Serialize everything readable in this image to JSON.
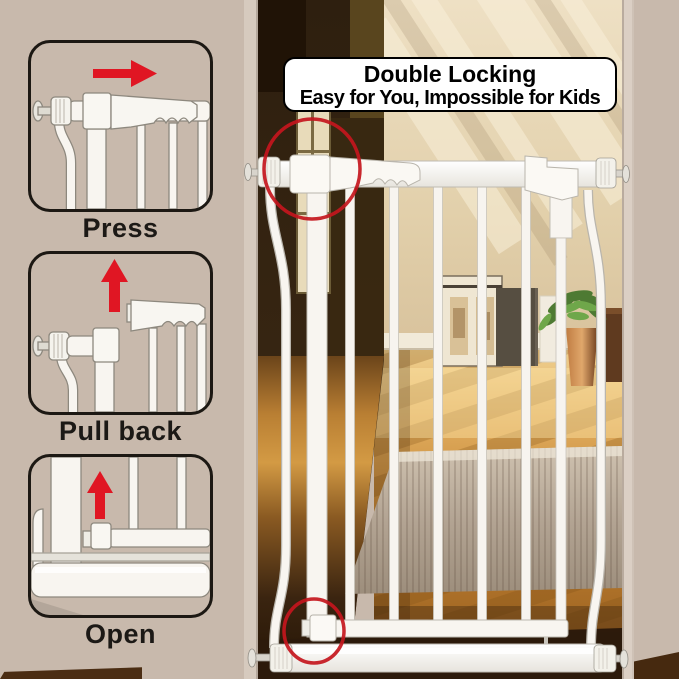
{
  "image_type": "product marketing image of a pressure-mounted baby safety gate installed in a doorway",
  "title_box": {
    "line1": "Double Locking",
    "line2": "Easy for You, Impossible for Kids"
  },
  "instruction_panels": [
    {
      "label": "Press",
      "arrow_direction": "right",
      "icon": "red-arrow-right-icon"
    },
    {
      "label": "Pull back",
      "arrow_direction": "up",
      "icon": "red-arrow-up-icon"
    },
    {
      "label": "Open",
      "arrow_direction": "up",
      "icon": "red-arrow-up-icon"
    }
  ],
  "photo": {
    "scene": "white metal safety gate in a doorway; dark hallway on left, sunlit beige wall, parquet wood floor, taupe rug, framed artwork, potted plant",
    "annotations": [
      {
        "name": "top-lock-highlight-circle",
        "shape": "circle",
        "color": "#c4161d"
      },
      {
        "name": "bottom-latch-highlight-circle",
        "shape": "circle",
        "color": "#c4161d"
      }
    ]
  },
  "colors": {
    "page_background": "#c8b9ac",
    "accent_red": "#d5161f",
    "highlight_circle_red": "#c4161d",
    "panel_border": "#1c1813",
    "title_text": "#000000",
    "title_box_background": "#ffffff",
    "gate_white": "#f8f5f0",
    "wall_beige": "#e6d6b6",
    "wood_floor": "#cf9035",
    "dark_doorway": "#2e1f0f",
    "rug_taupe": "#b3a493"
  }
}
